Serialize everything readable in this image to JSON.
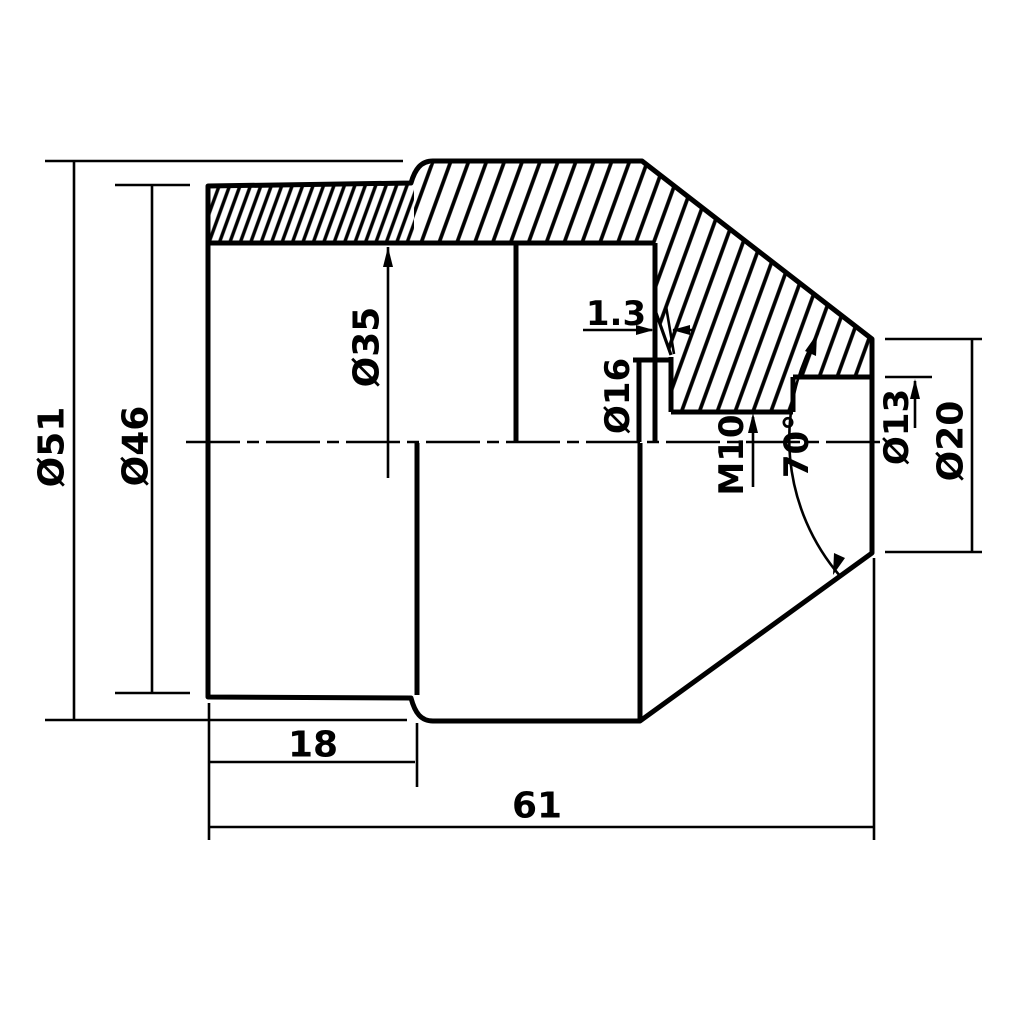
{
  "drawing": {
    "type": "engineering-cross-section",
    "colors": {
      "background": "#ffffff",
      "line": "#000000"
    },
    "labels": {
      "od51": "Ø51",
      "od46": "Ø46",
      "bore35": "Ø35",
      "cs16": "Ø16",
      "thread": "M10",
      "groove": "1.3",
      "angle": "70°",
      "hole13": "Ø13",
      "face20": "Ø20",
      "len18": "18",
      "len61": "61"
    }
  }
}
